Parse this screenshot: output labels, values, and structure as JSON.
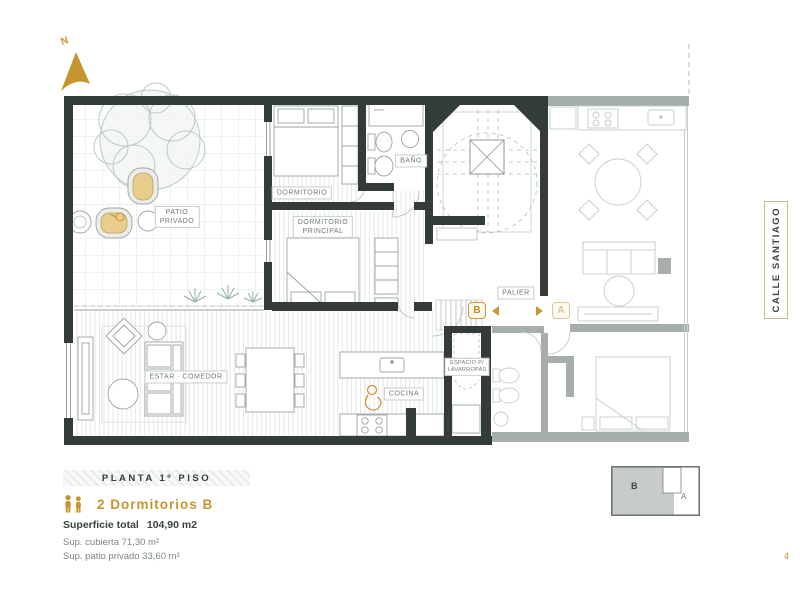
{
  "colors": {
    "gold": "#C7952E",
    "wall_dark": "#333B3B",
    "wall_faded": "#A6ADAD",
    "label_text": "#6E7878"
  },
  "north": {
    "label": "N"
  },
  "street": {
    "label": "CALLE SANTIAGO"
  },
  "rooms": {
    "patio": {
      "line1": "PATIO",
      "line2": "PRIVADO"
    },
    "dormitorio": "DORMITORIO",
    "principal": {
      "line1": "DORMITORIO",
      "line2": "PRINCIPAL"
    },
    "bano": "BAÑO",
    "palier": "PALIER",
    "estar": "ESTAR · COMEDOR",
    "cocina": "COCINA",
    "lavarropas": {
      "line1": "ESPACIO P/",
      "line2": "LAVARROPAS"
    }
  },
  "markers": {
    "b": "B",
    "a": "A"
  },
  "legend": {
    "floor_band": "PLANTA 1º PISO",
    "unit_title": "2 Dormitorios B",
    "superficie_label": "Superficie total",
    "superficie_value": "104,90 m2",
    "sup_cubierta": "Sup. cubierta 71,30 m²",
    "sup_patio": "Sup. patio privado 33,60 m²"
  },
  "keyplan": {
    "b": "B",
    "a": "A"
  },
  "page": {
    "number": "4"
  }
}
